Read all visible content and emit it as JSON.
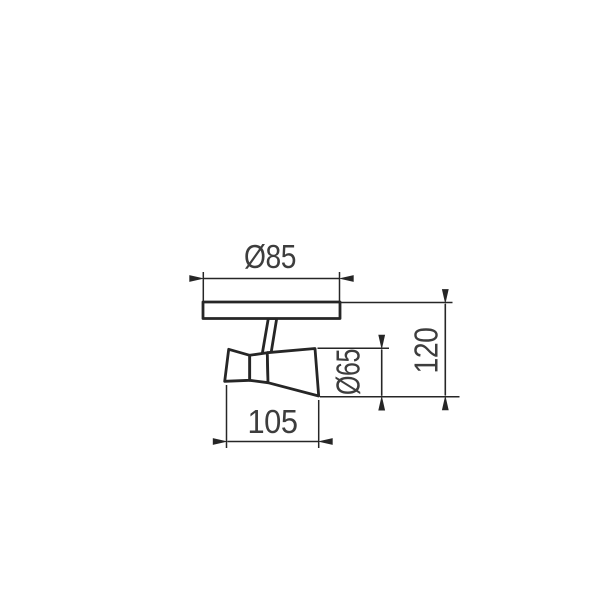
{
  "title": "Spotlight luminaire dimension drawing",
  "drawing": {
    "labels": {
      "plate_diameter": "Ø85",
      "head_length": "105",
      "head_diameter": "Ø65",
      "total_height": "120"
    },
    "colors": {
      "background": "#ffffff",
      "line": "#262626",
      "text": "#3d3d3d"
    }
  }
}
